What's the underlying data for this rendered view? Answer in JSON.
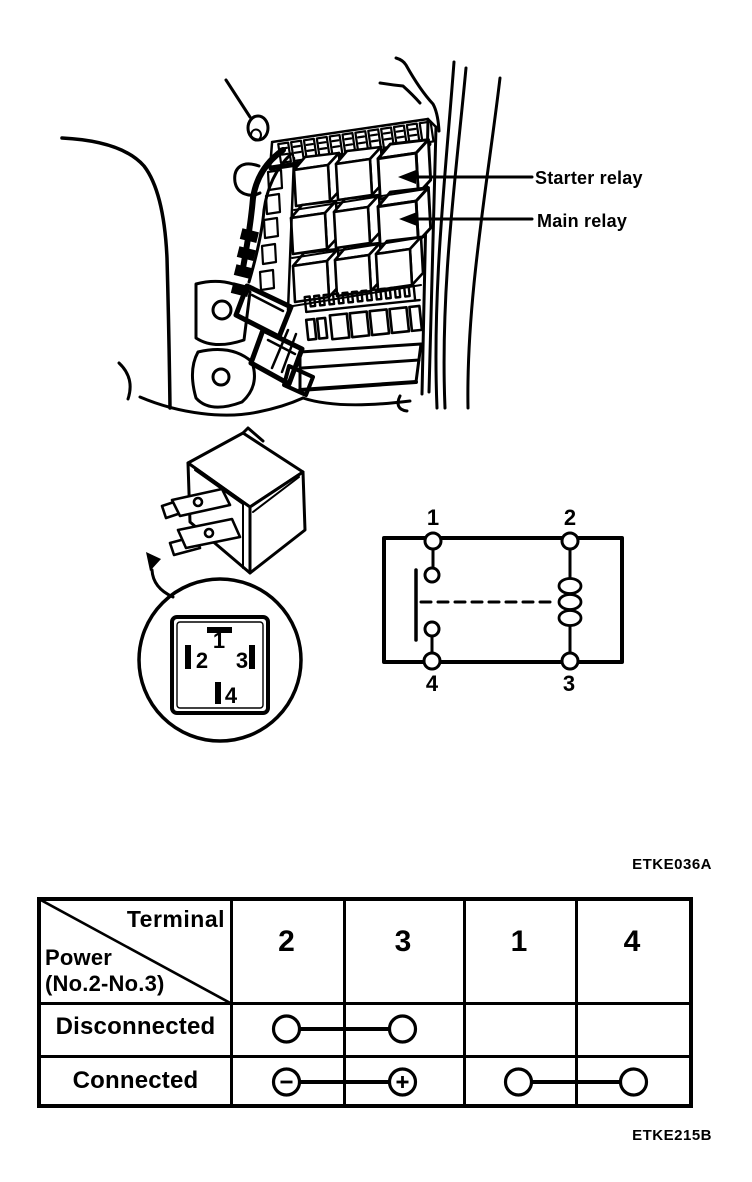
{
  "figure_top": {
    "starter_label": "Starter relay",
    "main_label": "Main relay",
    "code": "ETKE036A",
    "description": "Engine compartment relay box with arrows to starter relay and main relay"
  },
  "magnifier": {
    "pin1": "1",
    "pin2": "2",
    "pin3": "3",
    "pin4": "4",
    "description": "Bottom view of 4-pin relay connector"
  },
  "circuit": {
    "t_top_left": "1",
    "t_top_right": "2",
    "t_bottom_left": "4",
    "t_bottom_right": "3",
    "description": "Relay internal circuit: contacts between 1-4, coil between 2-3"
  },
  "table": {
    "corner_top": "Terminal",
    "corner_bottom1": "Power",
    "corner_bottom2": "(No.2-No.3)",
    "columns": [
      "2",
      "3",
      "1",
      "4"
    ],
    "row1": {
      "label": "Disconnected"
    },
    "row2": {
      "label": "Connected"
    },
    "connections": [
      {
        "row": "Disconnected",
        "between": [
          "2",
          "3"
        ],
        "marks": [
          "plain",
          "plain"
        ]
      },
      {
        "row": "Connected",
        "between": [
          "2",
          "3"
        ],
        "marks": [
          "minus",
          "plus"
        ]
      },
      {
        "row": "Connected",
        "between": [
          "1",
          "4"
        ],
        "marks": [
          "plain",
          "plain"
        ]
      }
    ],
    "code": "ETKE215B"
  }
}
